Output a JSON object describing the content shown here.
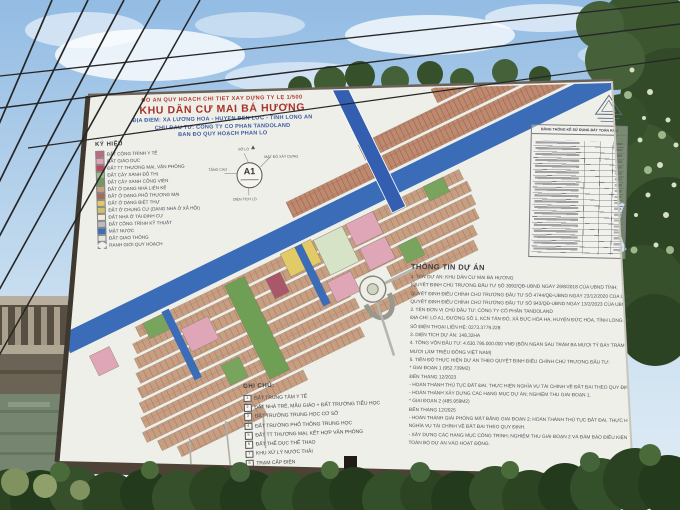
{
  "billboard": {
    "header": {
      "line1": "ĐỒ ÁN QUY HOẠCH CHI TIẾT XÂY DỰNG TỶ LỆ 1/500",
      "title": "KHU DÂN CƯ MAI BÁ HƯƠNG",
      "line3": "ĐỊA ĐIỂM: XÃ LƯƠNG HÒA - HUYỆN BẾN LỨC - TỈNH LONG AN",
      "line4": "CHỦ ĐẦU TƯ: CÔNG TY CỔ PHẦN TANDOLAND",
      "line5": "BẢN ĐỒ QUY HOẠCH PHÂN LÔ"
    },
    "legend": {
      "title": "KÝ HIỆU",
      "items": [
        {
          "label": "ĐẤT CÔNG TRÌNH Y TẾ",
          "color": "#c06a7a",
          "border": "solid"
        },
        {
          "label": "ĐẤT GIÁO DỤC",
          "color": "#e2a3b5",
          "border": "solid"
        },
        {
          "label": "ĐẤT TT THƯƠNG MẠI, VĂN PHÒNG",
          "color": "#b94b5c",
          "border": "solid"
        },
        {
          "label": "ĐẤT CÂY XANH ĐÔ THỊ",
          "color": "#9cbf7f",
          "border": "solid"
        },
        {
          "label": "ĐẤT CÂY XANH CÔNG VIÊN",
          "color": "#6f9e55",
          "border": "solid"
        },
        {
          "label": "ĐẤT Ở DẠNG NHÀ LIÊN KẾ",
          "color": "#c8a07f",
          "border": "solid"
        },
        {
          "label": "ĐẤT Ở DẠNG PHỐ THƯƠNG MẠI",
          "color": "#a86a58",
          "border": "solid"
        },
        {
          "label": "ĐẤT Ở DẠNG BIỆT THỰ",
          "color": "#e2cb66",
          "border": "solid"
        },
        {
          "label": "ĐẤT Ở CHUNG CƯ (DẠNG NHÀ Ở XÃ HỘI)",
          "color": "#cfc06a",
          "border": "solid"
        },
        {
          "label": "ĐẤT NHÀ Ở TÁI ĐỊNH CƯ",
          "color": "#f1ecd9",
          "border": "solid"
        },
        {
          "label": "ĐẤT CÔNG TRÌNH KỸ THUẬT",
          "color": "#bcbcbc",
          "border": "solid"
        },
        {
          "label": "MẶT NƯỚC",
          "color": "#3b6cb8",
          "border": "solid"
        },
        {
          "label": "ĐẤT GIAO THÔNG",
          "color": "#e4e4de",
          "border": "solid"
        },
        {
          "label": "RANH GIỚI QUY HOẠCH",
          "color": "#f1f1ea",
          "border": "dashed"
        }
      ]
    },
    "parcel_key": {
      "center": "A1",
      "top_label": "SỐ LÔ",
      "left_label": "TẦNG CAO",
      "right_label": "MẬT ĐỘ XÂY DỰNG",
      "bottom_label": "DIỆN TÍCH LÔ"
    },
    "stats_table": {
      "title": "BẢNG THỐNG KÊ SỬ DỤNG ĐẤT TOÀN KHU"
    },
    "project_info": {
      "title": "THÔNG TIN DỰ ÁN",
      "lines": [
        "1. TÊN DỰ ÁN: KHU DÂN CƯ MAI BÁ HƯƠNG",
        "(QUYẾT ĐỊNH CHỦ TRƯƠNG ĐẦU TƯ SỐ 3092/QĐ-UBND NGÀY 29/8/2018 CỦA UBND TỈNH;",
        "QUYẾT ĐỊNH ĐIỀU CHỈNH CHỦ TRƯƠNG ĐẦU TƯ SỐ 4744/QĐ-UBND NGÀY 23/12/2020 CỦA UBND TỈNH;",
        "QUYẾT ĐỊNH ĐIỀU CHỈNH CHỦ TRƯƠNG ĐẦU TƯ SỐ 943/QĐ-UBND NGÀY 13/2/2023 CỦA UBND TỈNH)",
        "2. TÊN ĐƠN VỊ CHỦ ĐẦU TƯ: CÔNG TY CỔ PHẦN TANDOLAND",
        "ĐỊA CHỈ: LÔ A1, ĐƯỜNG SỐ 1, KCN TÂN ĐÔ, XÃ ĐỨC HÒA HẠ, HUYỆN ĐỨC HÒA, TỈNH LONG AN",
        "SỐ ĐIỆN THOẠI LIÊN HỆ: 0273.3779.228",
        "3. DIỆN TÍCH DỰ ÁN: 148,32HA",
        "4. TỔNG VỐN ĐẦU TƯ: 4.630.795.000.000 VNĐ (BỐN NGÀN SÁU TRĂM BA MƯƠI TỶ BẢY TRĂM CHÍN",
        "MƯƠI LĂM TRIỆU ĐỒNG VIỆT NAM)",
        "5. TIẾN ĐỘ THỰC HIỆN DỰ ÁN THEO QUYẾT ĐỊNH ĐIỀU CHỈNH CHỦ TRƯƠNG ĐẦU TƯ:",
        "* GIAI ĐOẠN 1 (952.739M2)",
        "ĐẾN THÁNG 12/2023",
        "- HOÀN THÀNH THỦ TỤC ĐẤT ĐAI, THỰC HIỆN NGHĨA VỤ TÀI CHÍNH VỀ ĐẤT ĐAI THEO QUY ĐỊNH;",
        "- HOÀN THÀNH XÂY DỰNG CÁC HẠNG MỤC DỰ ÁN; NGHIỆM THU GIAI ĐOẠN 1.",
        "* GIAI ĐOẠN 2 (485.959M2)",
        "ĐẾN THÁNG 12/2025",
        "- HOÀN THÀNH GIẢI PHÓNG MẶT BẰNG GIAI ĐOẠN 2; HOÀN THÀNH THỦ TỤC ĐẤT ĐAI, THỰC HIỆN",
        "NGHĨA VỤ TÀI CHÍNH VỀ ĐẤT ĐAI THEO QUY ĐỊNH.",
        "- XÂY DỰNG CÁC HẠNG MỤC CÔNG TRÌNH; NGHIỆM THU GIAI ĐOẠN 2 VÀ ĐẢM BẢO ĐIỀU KIỆN ĐƯA",
        "TOÀN BỘ DỰ ÁN VÀO HOẠT ĐỘNG."
      ]
    },
    "notes": {
      "title": "GHI CHÚ:",
      "items": [
        {
          "num": "1",
          "label": "ĐẤT TRUNG TÂM Y TẾ"
        },
        {
          "num": "2",
          "label": "ĐẤT NHÀ TRẺ, MẪU GIÁO + ĐẤT TRƯỜNG TIỂU HỌC"
        },
        {
          "num": "3",
          "label": "ĐẤT TRƯỜNG TRUNG HỌC CƠ SỞ"
        },
        {
          "num": "4",
          "label": "ĐẤT TRƯỜNG PHỔ THÔNG TRUNG HỌC"
        },
        {
          "num": "5",
          "label": "ĐẤT TT THƯƠNG MẠI, KẾT HỢP VĂN PHÒNG"
        },
        {
          "num": "6",
          "label": "ĐẤT THỂ DỤC THỂ THAO"
        },
        {
          "num": "7",
          "label": "KHU XỬ LÝ NƯỚC THẢI"
        },
        {
          "num": "8",
          "label": "TRẠM CẤP ĐIỆN"
        }
      ]
    },
    "map_colors": {
      "water": "#3b6cb8",
      "row_housing": "#c69f82",
      "shophouse": "#bd8a70",
      "education_pink": "#dfa6b8",
      "park_green": "#6f9e55",
      "villa_yellow": "#e2cb66",
      "resettlement_mint": "#d6e3c6"
    }
  }
}
